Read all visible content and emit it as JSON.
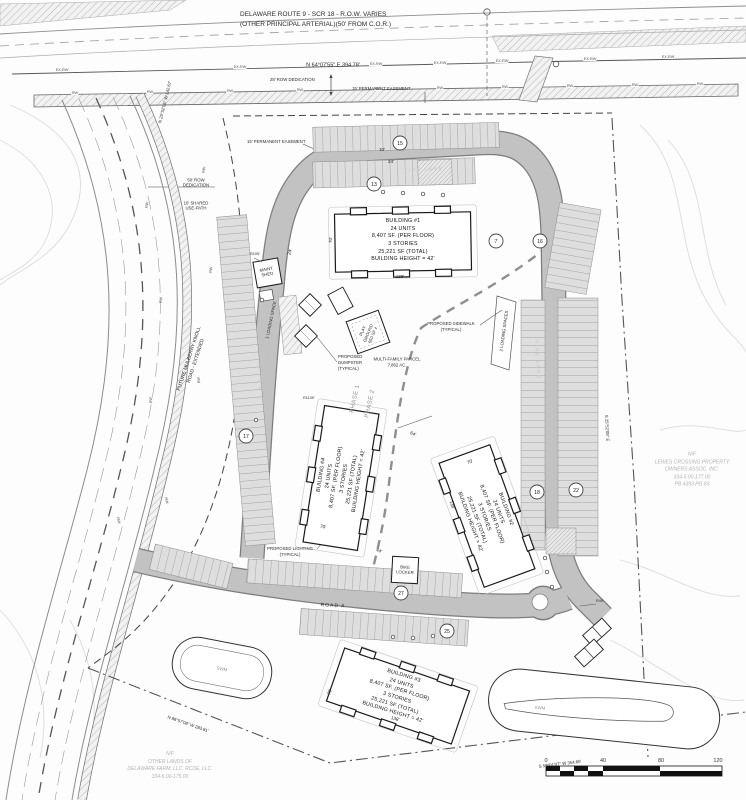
{
  "route9": {
    "title_line1": "DELAWARE ROUTE 9 - SCR 18 - R.O.W. VARIES",
    "title_line2": "(OTHER PRINCIPAL ARTERIAL)(50' FROM C.O.R.)",
    "bearing": "N 64°07'55\" E  394.78'",
    "row_dedication": "28' ROW DEDICATION",
    "easement1": "15' PERMANENT EASEMENT",
    "easement2": "15' PERMANENT EASEMENT",
    "ex_rw": "EX-RW",
    "rw": "RW"
  },
  "mulberry": {
    "bearing": "N 25°52'05\" W  142.67'",
    "row_dedication_l1": "50' ROW",
    "row_dedication_l2": "DEDICATION",
    "shared_path_l1": "10' SHARED",
    "shared_path_l2": "USE-PATH",
    "name_l1": "FUTURE MULBERRY KNOLL",
    "name_l2": "ROAD - EXTENDED"
  },
  "site": {
    "maint_shed_l1": "MAINT.",
    "maint_shed_l2": "SHED",
    "loading1": "1 LOADING SPACE",
    "loading2": "2 LOADING SPACES",
    "playground_l1": "PLAY",
    "playground_l2": "GROUND",
    "playground_l3": "650 SF ±",
    "dumpster_l1": "PROPOSED",
    "dumpster_l2": "DUMPSTER",
    "dumpster_l3": "(TYPICAL)",
    "parcel_l1": "MULTI-FAMILY PARCEL",
    "parcel_l2": "7.862 AC.",
    "phase1": "PHASE 1",
    "phase2": "PHASE 2",
    "sidewalk_l1": "PROPOSED SIDEWALK",
    "sidewalk_l2": "(TYPICAL)",
    "lighting_l1": "PROPOSED LIGHTING",
    "lighting_l2": "(TYPICAL)",
    "bike_locker_l1": "BIKE",
    "bike_locker_l2": "LOCKER",
    "road_a": "ROAD A",
    "swm": "SWM",
    "fire_lane": "FIRE LANE",
    "r105": "R105'",
    "r1139": "R1139'",
    "r49": "R49'",
    "dim70": "70'",
    "dim138": "138'",
    "dim64": "64'",
    "dim44": "44'",
    "dim24": "24'",
    "dim10": "10'"
  },
  "buildings": [
    {
      "name": "BUILDING #1",
      "units": "24 UNITS",
      "per_floor": "8,407 SF. (PER FLOOR)",
      "stories": "3 STORIES",
      "total": "25,221 SF (TOTAL)",
      "height": "BUILDING HEIGHT = 42'"
    },
    {
      "name": "BUILDING #2",
      "units": "24 UNITS",
      "per_floor": "8,407 SF. (PER FLOOR)",
      "stories": "3 STORIES",
      "total": "25,221 SF (TOTAL)",
      "height": "BUILDING HEIGHT = 42'"
    },
    {
      "name": "BUILDING #3",
      "units": "24 UNITS",
      "per_floor": "8,407 SF. (PER FLOOR)",
      "stories": "3 STORIES",
      "total": "25,221 SF (TOTAL)",
      "height": "BUILDING HEIGHT = 42'"
    },
    {
      "name": "BUILDING #4",
      "units": "24 UNITS",
      "per_floor": "8,407 SF. (PER FLOOR)",
      "stories": "3 STORIES",
      "total": "25,221 SF (TOTAL)",
      "height": "BUILDING HEIGHT = 42'"
    }
  ],
  "parking_counts": [
    "15",
    "13",
    "7",
    "16",
    "17",
    "18",
    "22",
    "27",
    "25"
  ],
  "owners": {
    "lewes_l1": "N/F",
    "lewes_l2": "LEWES CROSSING PROPERTY",
    "lewes_l3": "OWNERS ASSOC. INC.",
    "lewes_l4": "334-5.00-177.00",
    "lewes_l5": "PB 4393 PG 83",
    "farm_l1": "N/F",
    "farm_l2": "OTHER LANDS OF",
    "farm_l3": "DELAWARE FARM, LLC. RCDE, LLC.",
    "farm_l4": "334-5.00-175.00"
  },
  "boundary": {
    "bearing_sw": "N 88°07'08\" W  283.81'",
    "bearing_se": "S 59°01'07\" W  354.60'",
    "bearing_e": "S 25°52'05\" E"
  },
  "scale": {
    "ticks": [
      "0",
      "40",
      "80",
      "120"
    ]
  }
}
